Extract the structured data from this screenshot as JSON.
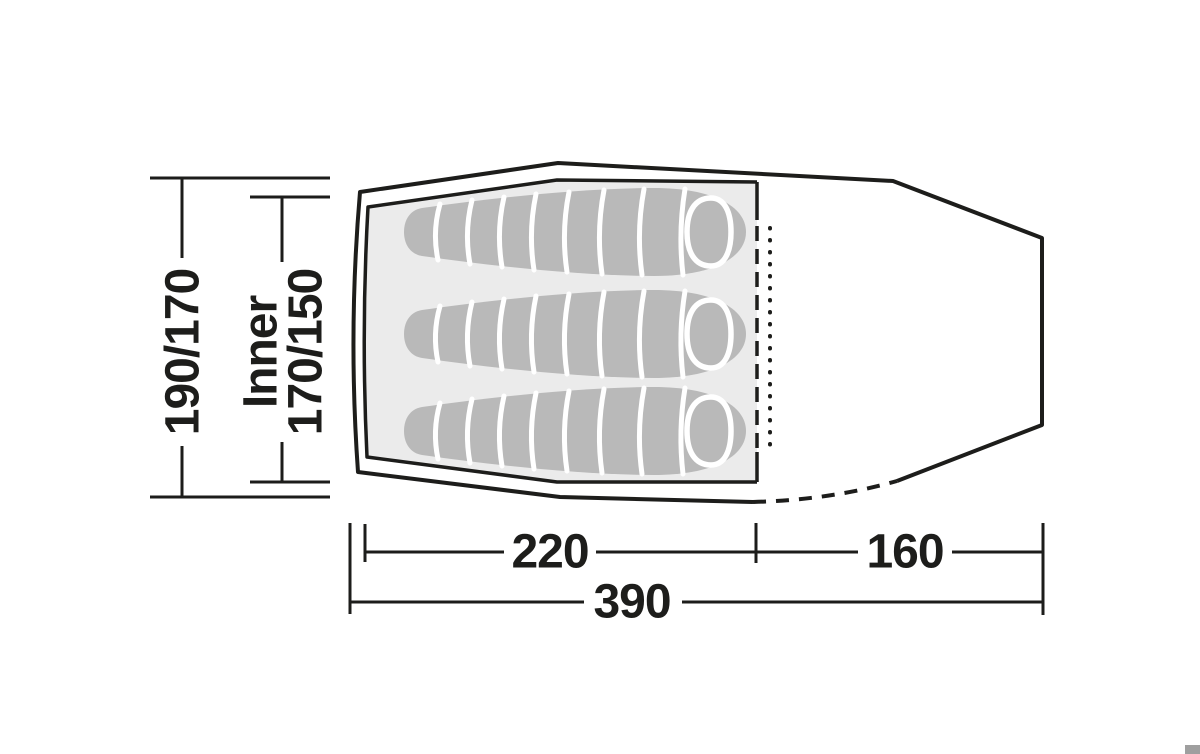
{
  "labels": {
    "outer_width": "190/170",
    "inner_width_line1": "Inner",
    "inner_width_line2": "170/150",
    "inner_length": "220",
    "porch_length": "160",
    "total_length": "390"
  },
  "colors": {
    "line": "#1d1d1b",
    "inner_tent_fill": "#ebebeb",
    "sleeping_bag_fill": "#b9b9b9",
    "stripe": "#ffffff",
    "background": "#ffffff",
    "corner_mark": "#9f9f9f"
  }
}
